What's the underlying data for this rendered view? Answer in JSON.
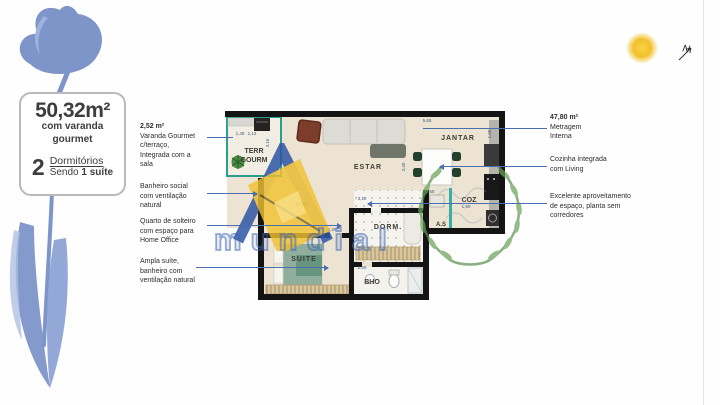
{
  "info_box": {
    "area": "50,32m²",
    "line1": "com varanda",
    "line2": "gourmet",
    "qty": "2",
    "qty_label": "Dormitórios",
    "sub_prefix": "Sendo",
    "sub_bold": "1 suíte"
  },
  "annotations": {
    "left": [
      {
        "title": "2,52 m²",
        "lines": [
          "Varanda Gourmet",
          "c/terraço,",
          "Integrada com a",
          "sala"
        ]
      },
      {
        "title": "",
        "lines": [
          "Banheiro social",
          "com ventilação",
          "natural"
        ]
      },
      {
        "title": "",
        "lines": [
          "Quarto de solteiro",
          "com espaço para",
          "Home Office"
        ]
      },
      {
        "title": "",
        "lines": [
          "Ampla suíte,",
          "banheiro com",
          "ventilação natural"
        ]
      }
    ],
    "right": [
      {
        "title": "47,80 m²",
        "lines": [
          "Metragem",
          "Interna"
        ]
      },
      {
        "title": "",
        "lines": [
          "Cozinha integrada",
          "com Living"
        ]
      },
      {
        "title": "",
        "lines": [
          "Excelente aproveitamento",
          "de espaço, planta sem",
          "corredores"
        ]
      }
    ]
  },
  "floorplan": {
    "labels": {
      "terraco1": "TERR",
      "terraco2": "GOURM",
      "estar": "ESTAR",
      "jantar": "JANTAR",
      "coz": "COZ",
      "as": "A.S",
      "dorm": "DORM.",
      "suite": "SUITE",
      "bho": "BHO",
      "bho_faint": "BHO"
    },
    "dims": {
      "terraco": "3,15",
      "t1": "1,48",
      "t2": "1,13",
      "top": "5,65",
      "right": "1,60",
      "estar": "2,40",
      "dorm": "3,10",
      "as": "1,50",
      "suite": "4,29",
      "bho": "2,50",
      "coz": "1,90"
    }
  },
  "watermark": {
    "brand": "mundial"
  },
  "compass": {
    "label": "N"
  },
  "colors": {
    "leader_line": "#4a6fae",
    "terrace_accent": "#2a9d8f",
    "watermark_blue": "#3f68b5",
    "watermark_yellow": "#f2c12e",
    "laurel_green": "#5d9150",
    "flower_blue": "#7d95c9",
    "wall": "#141414",
    "floor": "#ece3d3"
  }
}
